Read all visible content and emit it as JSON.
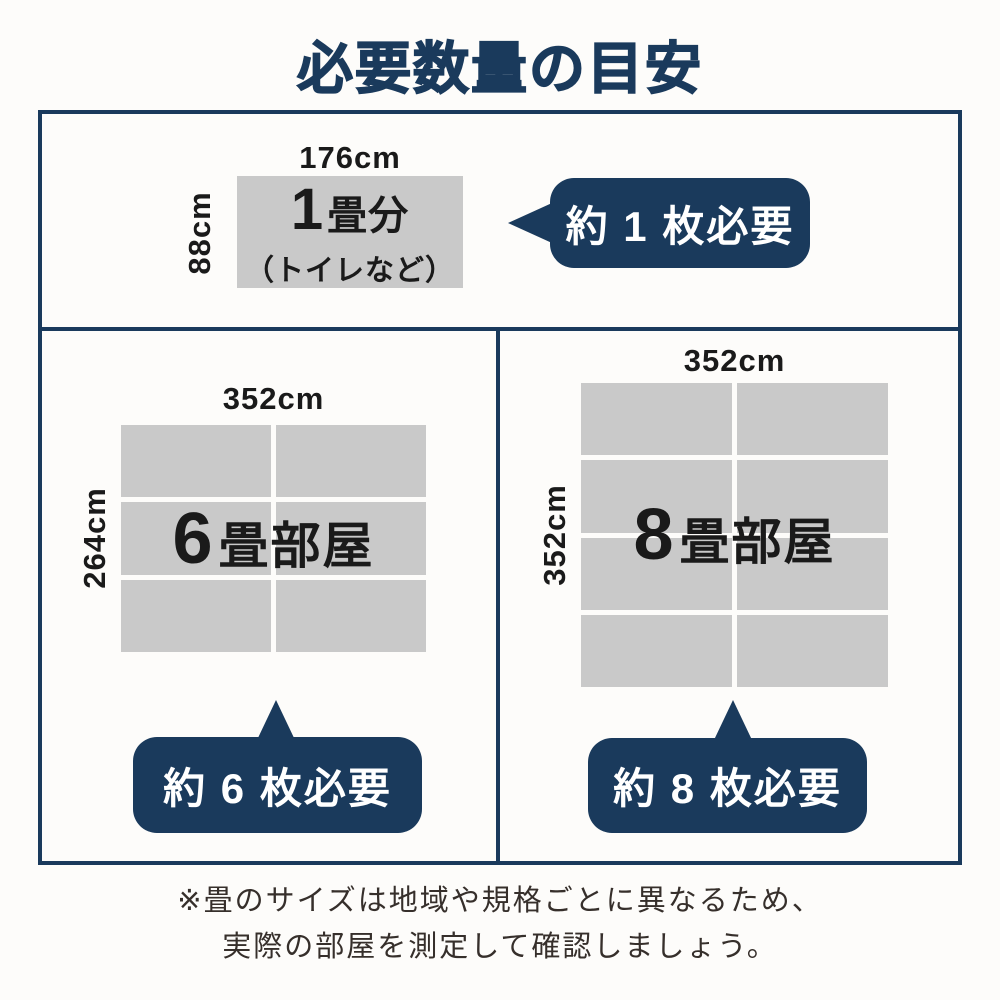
{
  "page": {
    "title": "必要数量の目安",
    "colors": {
      "accent_navy": "#1a3a5c",
      "tatami_gray": "#c9c9c9",
      "background": "#fdfcfa",
      "text_ink": "#1a1a1a",
      "footer_ink": "#362f2b"
    }
  },
  "sections": {
    "one_mat": {
      "width_label": "176cm",
      "height_label": "88cm",
      "name_number": "1",
      "name_suffix": "畳分",
      "name_note": "（トイレなど）",
      "callout": "約 1 枚必要"
    },
    "six_mat": {
      "width_label": "352cm",
      "height_label": "264cm",
      "name_number": "6",
      "name_suffix": "畳部屋",
      "callout": "約 6 枚必要",
      "grid": {
        "cols": 2,
        "rows": 3
      }
    },
    "eight_mat": {
      "width_label": "352cm",
      "height_label": "352cm",
      "name_number": "8",
      "name_suffix": "畳部屋",
      "callout": "約 8 枚必要",
      "grid": {
        "cols": 2,
        "rows": 4
      }
    }
  },
  "footer": {
    "line1": "※畳のサイズは地域や規格ごとに異なるため、",
    "line2": "実際の部屋を測定して確認しましょう。"
  }
}
